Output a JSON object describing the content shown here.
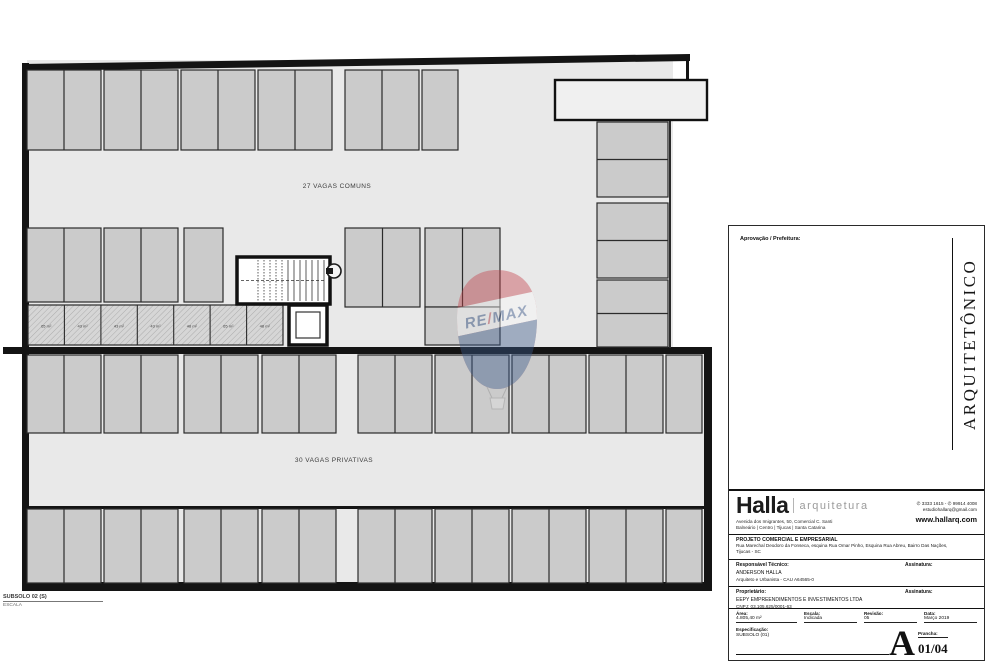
{
  "colors": {
    "remax_red": "#c5434b",
    "remax_blue": "#2e4e85",
    "stall_fill": "#cbcbcb",
    "floor_fill": "#e9e9e9",
    "wall": "#141414"
  },
  "plan": {
    "upper_zone_label": "27 VAGAS COMUNS",
    "lower_zone_label": "30 VAGAS PRIVATIVAS",
    "hatch_labels": [
      "65 m²",
      "43 m²",
      "43 m²",
      "43 m²",
      "48 m²",
      "65 m²",
      "48 m²"
    ],
    "caption": {
      "title": "SUBSOLO 02 (S)",
      "scale_label": "ESCALA"
    },
    "watermark": {
      "re": "RE",
      "slash": "/",
      "max": "MAX"
    }
  },
  "titleblock": {
    "approval_label": "Aprovação / Prefeitura:",
    "discipline": "ARQUITETÔNICO",
    "brand": {
      "name": "Halla",
      "tagline": "arquitetura",
      "address_line1": "Avenida dos Imigrantes, 50, Comercial C. Santi",
      "address_line2": "Balneário | Centro | Tijucas | Santa Catarina",
      "phones": "✆ 3333 1615 - ✆ 99914 4008",
      "email": "estudiohallarq@gmail.com",
      "website": "www.hallarq.com"
    },
    "project": {
      "title": "PROJETO COMERCIAL E EMPRESARIAL",
      "address_line1": "Rua Marechal Deodoro da Fonseca, esquina Rua Omar Pinho, Esquina Rua Abreu, Bairro Das Nações,",
      "address_line2": "Tijucas - SC"
    },
    "responsible": {
      "label": "Responsável Técnico:",
      "name": "ANDERSON HALLA",
      "role": "Arquiteto e Urbanista - CAU A64565-0",
      "signature_label": "Assinatura:"
    },
    "owner": {
      "label": "Proprietário:",
      "name": "EEPY EMPREENDIMENTOS E INVESTIMENTOS LTDA",
      "cnpj": "CNPJ: 03.105.625/0001-63",
      "signature_label": "Assinatura:"
    },
    "fields": {
      "area_label": "Área:",
      "area_value": "4.805,40 m²",
      "scale_label": "Escala:",
      "scale_value": "Indicada",
      "revision_label": "Revisão:",
      "revision_value": "05",
      "date_label": "Data:",
      "date_value": "Março 2019",
      "spec_label": "Especificação:",
      "spec_value": "SUBSOLO (01)",
      "sheet_label": "Prancha:",
      "sheet_letter": "A",
      "sheet_number": "01/04"
    }
  }
}
